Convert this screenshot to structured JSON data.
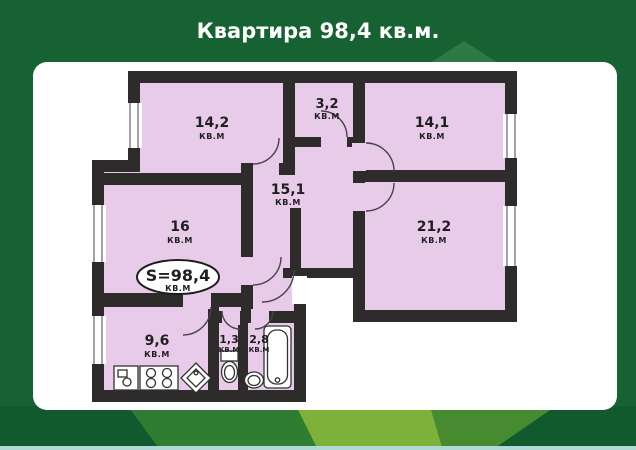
{
  "title": "Квартира 98,4 кв.м.",
  "plan": {
    "total_badge": {
      "value": "S=98,4",
      "unit": "КВ.М"
    },
    "rooms": [
      {
        "id": "room-14-2",
        "area": "14,2",
        "unit": "КВ.М"
      },
      {
        "id": "room-3-2",
        "area": "3,2",
        "unit": "КВ.М"
      },
      {
        "id": "room-14-1",
        "area": "14,1",
        "unit": "КВ.М"
      },
      {
        "id": "hall-15-1",
        "area": "15,1",
        "unit": "КВ.М"
      },
      {
        "id": "room-16",
        "area": "16",
        "unit": "КВ.М"
      },
      {
        "id": "room-21-2",
        "area": "21,2",
        "unit": "КВ.М"
      },
      {
        "id": "kitchen-9-6",
        "area": "9,6",
        "unit": "КВ.М"
      },
      {
        "id": "wc-1-3",
        "area": "1,3",
        "unit": "КВ.М"
      },
      {
        "id": "bath-2-8",
        "area": "2,8",
        "unit": "КВ.М"
      }
    ]
  },
  "colors": {
    "background": "#176232",
    "panel": "#ffffff",
    "room_fill": "#e8cbe8",
    "wall": "#2e2b2b",
    "stripe_dark": "#115a2e",
    "stripe_mid": "#2f7d31",
    "stripe_light": "#7eb13a",
    "stripe_mid2": "#478b31",
    "bottom_line": "#aed9d6"
  }
}
